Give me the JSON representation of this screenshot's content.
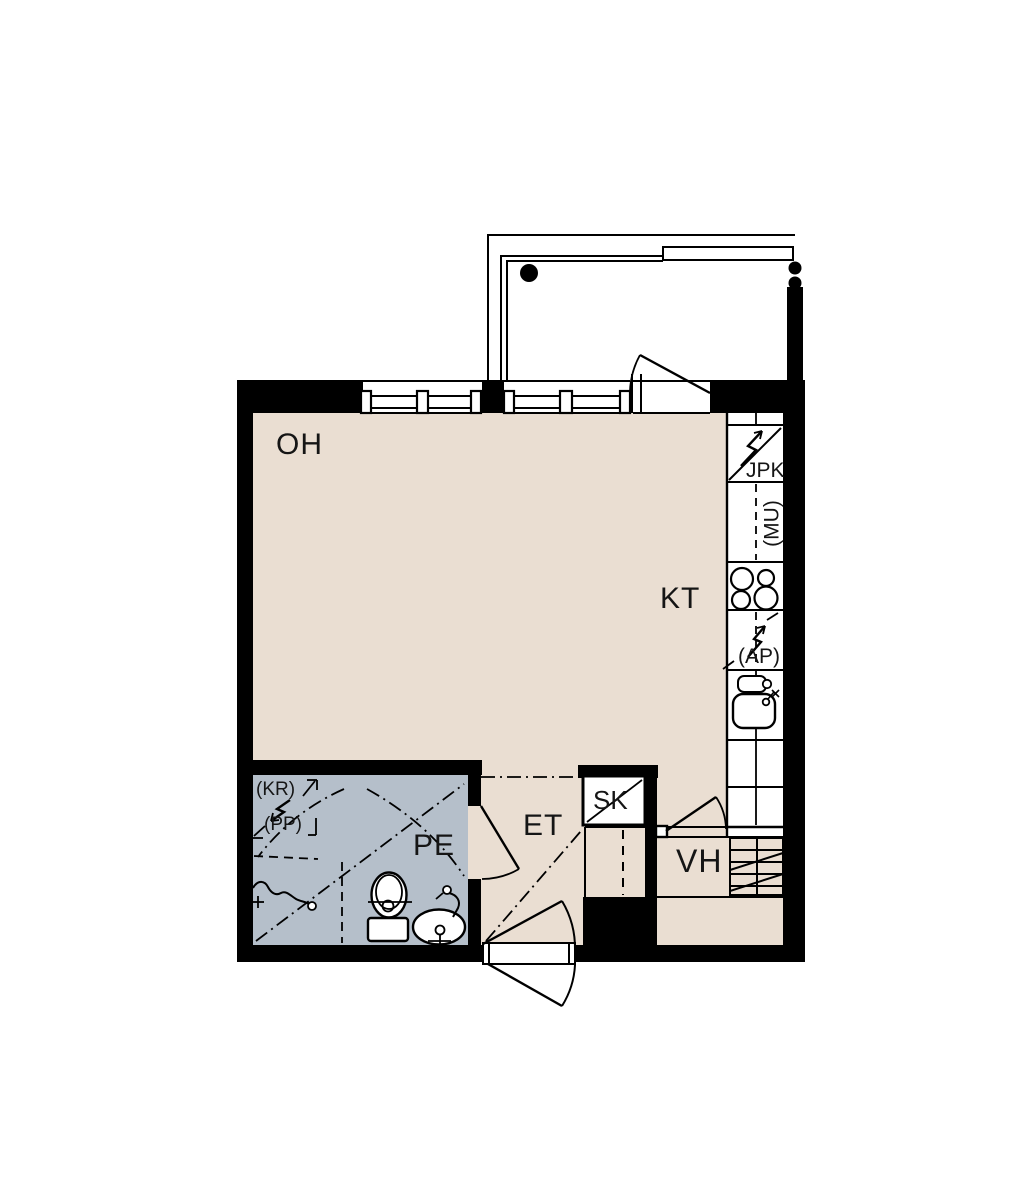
{
  "plan": {
    "type": "apartment-floor-plan",
    "background": "#ffffff"
  },
  "colors": {
    "wall": "#000000",
    "floor_main": "#EADED2",
    "floor_wet": "#B5BFCA",
    "fixture_fill": "#ffffff",
    "line": "#000000"
  },
  "rooms": {
    "living": {
      "label": "OH"
    },
    "kitchen": {
      "label": "KT"
    },
    "bathroom": {
      "label": "PE"
    },
    "entry": {
      "label": "ET"
    },
    "walk_in_closet": {
      "label": "VH"
    },
    "cleaning_closet": {
      "label": "SK"
    }
  },
  "appliances": {
    "fridge_freezer": {
      "label": "JPK"
    },
    "microwave_reservation": {
      "label": "(MU)"
    },
    "dishwasher_reservation": {
      "label": "(AP)"
    },
    "dryer_reservation": {
      "label": "(KR)"
    },
    "washer_reservation": {
      "label": "(PP)"
    }
  }
}
